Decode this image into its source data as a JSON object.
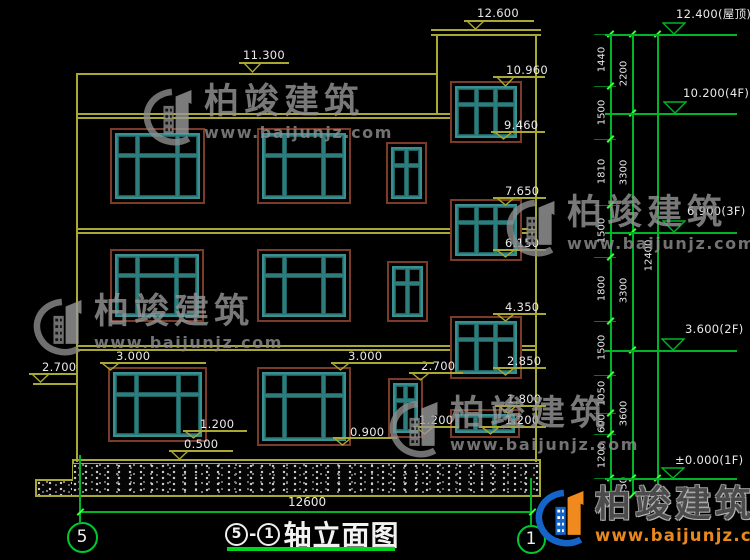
{
  "title_block": {
    "axis_left": "5",
    "dash": "-",
    "axis_right": "1",
    "name": "轴立面图"
  },
  "bottom_dimension": "12600",
  "axis_bubbles": [
    {
      "label": "5",
      "cx": 82,
      "cy": 537,
      "d": 31
    },
    {
      "label": "1",
      "cx": 531,
      "cy": 539,
      "d": 29
    }
  ],
  "watermark": {
    "cn": "柏竣建筑",
    "url": "www.baijunjz.com"
  },
  "brand_footer": {
    "cn": "柏竣建筑",
    "url": "www.baijunjz.com"
  },
  "colors": {
    "line_yellow": "#a8a832",
    "dim_green": "#00b428",
    "tick_green": "#39ff39",
    "window_teal": "#3a9090",
    "window_trim": "#7a3b28",
    "text": "#e9e9e9",
    "watermark_gray": "#969696",
    "brand_blue": "#1565c8",
    "brand_orange": "#f08a1e"
  },
  "facade": {
    "lines": [
      [
        76,
        73,
        2,
        389
      ],
      [
        535,
        35,
        2,
        427
      ],
      [
        76,
        73,
        361,
        2
      ],
      [
        76,
        113,
        377,
        1.5
      ],
      [
        76,
        117,
        377,
        1.5
      ],
      [
        431,
        29,
        110,
        2
      ],
      [
        431,
        34,
        110,
        1.5
      ],
      [
        436,
        35,
        2,
        80
      ],
      [
        76,
        228,
        376,
        1.5
      ],
      [
        76,
        232,
        376,
        1.5
      ],
      [
        522,
        228,
        14,
        1.5
      ],
      [
        522,
        232,
        14,
        1.5
      ],
      [
        76,
        345,
        376,
        1.5
      ],
      [
        76,
        349,
        376,
        1.5
      ],
      [
        522,
        345,
        14,
        1.5
      ],
      [
        522,
        349,
        14,
        1.5
      ],
      [
        33,
        383,
        45,
        2
      ],
      [
        72,
        459,
        469,
        1.5
      ],
      [
        72,
        463,
        469,
        1
      ],
      [
        72,
        459,
        1.5,
        22
      ],
      [
        35,
        479,
        38,
        1.5
      ],
      [
        35,
        479,
        1.5,
        17
      ],
      [
        35,
        495,
        506,
        1.5
      ],
      [
        539,
        459,
        1.5,
        37
      ]
    ],
    "hatch_boxes": [
      [
        73,
        464,
        466,
        31
      ],
      [
        37,
        481,
        35,
        14
      ]
    ],
    "windows": [
      {
        "x": 110,
        "y": 128,
        "w": 95,
        "h": 76,
        "type": "w3"
      },
      {
        "x": 257,
        "y": 128,
        "w": 94,
        "h": 76,
        "type": "w3"
      },
      {
        "x": 386,
        "y": 142,
        "w": 41,
        "h": 62,
        "type": "n2"
      },
      {
        "x": 450,
        "y": 81,
        "w": 72,
        "h": 62,
        "type": "s3"
      },
      {
        "x": 110,
        "y": 249,
        "w": 94,
        "h": 73,
        "type": "w3"
      },
      {
        "x": 257,
        "y": 249,
        "w": 94,
        "h": 73,
        "type": "w3"
      },
      {
        "x": 387,
        "y": 261,
        "w": 41,
        "h": 61,
        "type": "n2"
      },
      {
        "x": 450,
        "y": 199,
        "w": 72,
        "h": 62,
        "type": "s3"
      },
      {
        "x": 108,
        "y": 367,
        "w": 99,
        "h": 75,
        "type": "w3"
      },
      {
        "x": 257,
        "y": 367,
        "w": 94,
        "h": 79,
        "type": "w3"
      },
      {
        "x": 388,
        "y": 378,
        "w": 35,
        "h": 60,
        "type": "n2"
      },
      {
        "x": 450,
        "y": 316,
        "w": 72,
        "h": 63,
        "type": "s3"
      },
      {
        "x": 450,
        "y": 409,
        "w": 70,
        "h": 29,
        "type": "b3"
      }
    ],
    "window_types": {
      "w3": {
        "cols": [
          25,
          50,
          25
        ],
        "rows": [
          32,
          68
        ]
      },
      "n2": {
        "cols": [
          50,
          50
        ],
        "rows": [
          32,
          68
        ]
      },
      "s3": {
        "cols": [
          34,
          32,
          34
        ],
        "rows": [
          32,
          68
        ]
      },
      "b3": {
        "cols": [
          34,
          33,
          33
        ],
        "rows": [
          100
        ]
      }
    }
  },
  "elevation_markers": [
    {
      "label": "12.600",
      "text": [
        477,
        6
      ],
      "line": [
        464,
        534,
        20
      ],
      "tri": [
        475,
        20,
        29
      ]
    },
    {
      "label": "11.300",
      "text": [
        243,
        48
      ],
      "line": [
        239,
        289,
        62
      ],
      "tri": [
        252,
        62,
        72
      ]
    },
    {
      "label": "10.960",
      "text": [
        506,
        63
      ],
      "line": [
        493,
        545,
        76
      ],
      "tri": [
        505,
        76,
        86
      ]
    },
    {
      "label": "9.460",
      "text": [
        504,
        118
      ],
      "line": [
        491,
        545,
        131
      ],
      "tri": [
        503,
        131,
        139
      ]
    },
    {
      "label": "7.650",
      "text": [
        505,
        184
      ],
      "line": [
        493,
        546,
        197
      ],
      "tri": [
        505,
        197,
        205
      ]
    },
    {
      "label": "6.150",
      "text": [
        505,
        236
      ],
      "line": [
        493,
        546,
        249
      ],
      "tri": [
        505,
        249,
        257
      ]
    },
    {
      "label": "4.350",
      "text": [
        505,
        300
      ],
      "line": [
        493,
        546,
        313
      ],
      "tri": [
        505,
        313,
        321
      ]
    },
    {
      "label": "2.850",
      "text": [
        507,
        354
      ],
      "line": [
        493,
        546,
        367
      ],
      "tri": [
        505,
        367,
        375
      ]
    },
    {
      "label": "2.700",
      "text": [
        421,
        359
      ],
      "line": [
        409,
        463,
        372
      ],
      "tri": [
        420,
        372,
        380
      ]
    },
    {
      "label": "1.800",
      "text": [
        507,
        392
      ],
      "line": [
        495,
        546,
        405
      ],
      "tri": [
        507,
        405,
        413
      ]
    },
    {
      "label": "1.200",
      "text": [
        505,
        413
      ],
      "line": [
        479,
        546,
        426
      ],
      "tri": [
        490,
        426,
        434
      ]
    },
    {
      "label": "1.200",
      "text": [
        419,
        413
      ],
      "line": [
        413,
        459,
        426
      ],
      "tri": [
        424,
        426,
        434
      ]
    },
    {
      "label": "2.700",
      "text": [
        42,
        360
      ],
      "line": [
        29,
        78,
        373
      ],
      "tri": [
        40,
        373,
        382
      ]
    },
    {
      "label": "3.000",
      "text": [
        116,
        349
      ],
      "line": [
        100,
        206,
        362
      ],
      "tri": [
        110,
        362,
        370
      ]
    },
    {
      "label": "3.000",
      "text": [
        348,
        349
      ],
      "line": [
        331,
        434,
        362
      ],
      "tri": [
        340,
        362,
        370
      ]
    },
    {
      "label": "1.200",
      "text": [
        200,
        417
      ],
      "line": [
        183,
        247,
        430
      ],
      "tri": [
        193,
        430,
        438
      ]
    },
    {
      "label": "0.500",
      "text": [
        184,
        437
      ],
      "line": [
        169,
        233,
        450
      ],
      "tri": [
        179,
        450,
        459
      ]
    },
    {
      "label": "0.900",
      "text": [
        350,
        425
      ],
      "line": [
        333,
        397,
        437
      ],
      "tri": [
        342,
        437,
        445
      ]
    }
  ],
  "right_dimensions": {
    "chain_lines_x": [
      610,
      632,
      657
    ],
    "chain_top_y": 34,
    "chain_bottom_y": 495,
    "fine_segments": [
      [
        34,
        86,
        "1440"
      ],
      [
        86,
        139,
        "1500"
      ],
      [
        139,
        205,
        "1810"
      ],
      [
        205,
        257,
        "1500"
      ],
      [
        257,
        321,
        "1800"
      ],
      [
        321,
        375,
        "1500"
      ],
      [
        375,
        413,
        "1050"
      ],
      [
        413,
        434,
        "600"
      ],
      [
        434,
        478,
        "1200"
      ]
    ],
    "floor_segments": [
      [
        34,
        113,
        "2200"
      ],
      [
        113,
        232,
        "3300"
      ],
      [
        232,
        350,
        "3300"
      ],
      [
        350,
        478,
        "3600"
      ],
      [
        478,
        495,
        "450"
      ]
    ],
    "overall_segment": [
      34,
      478,
      "12400"
    ],
    "level_markers": [
      {
        "label": "12.400(屋顶)",
        "y": 34,
        "text": [
          676,
          6
        ],
        "tri": [
          674,
          22
        ]
      },
      {
        "label": "10.200(4F)",
        "y": 113,
        "text": [
          683,
          86
        ],
        "tri": [
          675,
          101
        ]
      },
      {
        "label": "6.900(3F)",
        "y": 232,
        "text": [
          687,
          204
        ],
        "tri": [
          674,
          220
        ]
      },
      {
        "label": "3.600(2F)",
        "y": 350,
        "text": [
          685,
          322
        ],
        "tri": [
          673,
          338
        ]
      },
      {
        "label": "±0.000(1F)",
        "y": 478,
        "text": [
          675,
          453
        ],
        "tri": [
          673,
          467
        ]
      }
    ]
  },
  "bottom_axis": {
    "dim_line": [
      80,
      532,
      511
    ],
    "left_axis_line": [
      79,
      455,
      67
    ],
    "right_axis_line": [
      530,
      478,
      47
    ],
    "label_pos": [
      288,
      495
    ]
  },
  "watermarks_gray": [
    [
      142,
      85
    ],
    [
      505,
      196
    ],
    [
      32,
      295
    ],
    [
      388,
      397
    ]
  ],
  "brand_pos": [
    534,
    486
  ]
}
